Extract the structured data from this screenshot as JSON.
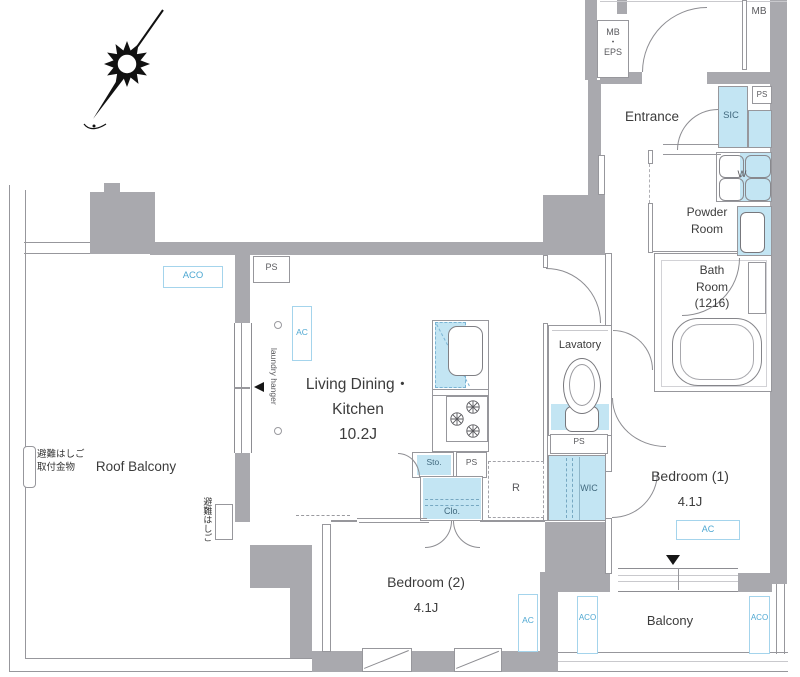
{
  "rooms": {
    "ldk": {
      "line1": "Living Dining・",
      "line2": "Kitchen",
      "size": "10.2J"
    },
    "bedroom1": {
      "name": "Bedroom (1)",
      "size": "4.1J"
    },
    "bedroom2": {
      "name": "Bedroom (2)",
      "size": "4.1J"
    },
    "roof_balcony": "Roof Balcony",
    "balcony": "Balcony",
    "entrance": "Entrance",
    "powder_room": {
      "line1": "Powder",
      "line2": "Room"
    },
    "bath_room": {
      "line1": "Bath",
      "line2": "Room",
      "line3": "(1216)"
    },
    "lavatory": "Lavatory"
  },
  "labels": {
    "mb": "MB",
    "mb_eps_1": "MB",
    "mb_eps_dot": "・",
    "mb_eps_2": "EPS",
    "sic": "SIC",
    "ps": "PS",
    "w": "W",
    "wic": "WIC",
    "sto": "Sto.",
    "clo": "Clo.",
    "r": "R",
    "ac": "AC",
    "aco": "ACO",
    "laundry_hanger": "laundry hanger",
    "evac_ladder_line1": "避難はしご",
    "evac_ladder_line2": "取付金物",
    "evac_ladder_vertical": "避難はしご"
  },
  "colors": {
    "wall_gray": "#a9a9ae",
    "highlight_blue": "#c3e5f3",
    "blue_outline": "#a4d4ec",
    "blue_text": "#4fa8d2",
    "slate_text": "#41697e",
    "dark_text": "#3c3c3c"
  }
}
